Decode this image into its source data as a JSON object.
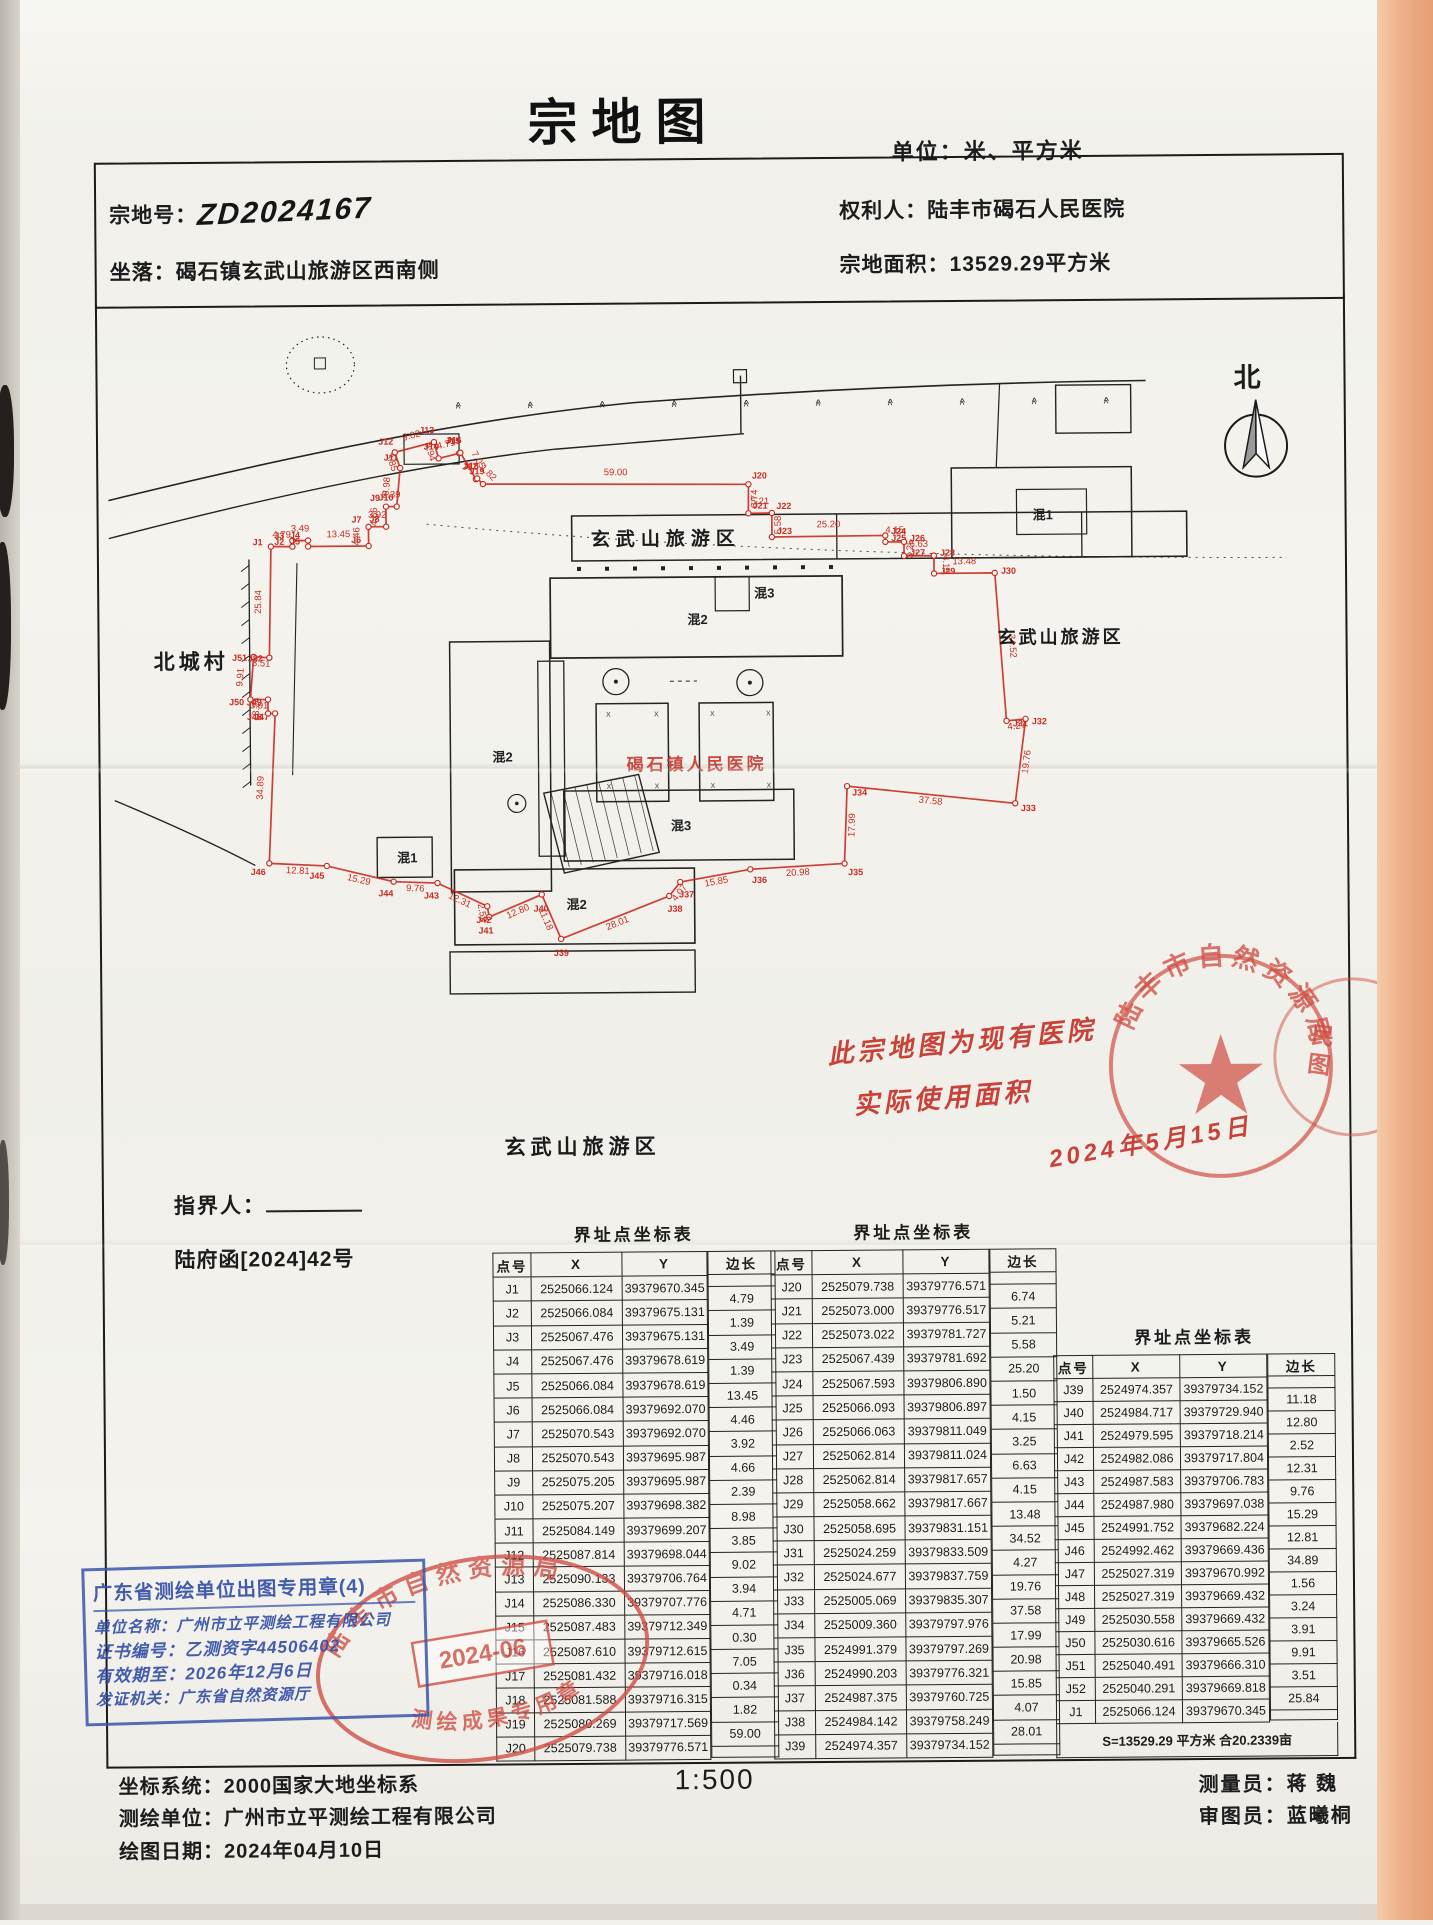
{
  "title": "宗地图",
  "unit_note": "单位：米、平方米",
  "header": {
    "parcel_no_label": "宗地号：",
    "parcel_no": "ZD2024167",
    "location_label": "坐落：",
    "location": "碣石镇玄武山旅游区西南侧",
    "owner_label": "权利人：",
    "owner": "陆丰市碣石人民医院",
    "area_label": "宗地面积：",
    "area": "13529.29平方米"
  },
  "compass": {
    "label": "北"
  },
  "map": {
    "labels": [
      {
        "role": "tourist-area-top",
        "text": "玄武山旅游区"
      },
      {
        "role": "village-left",
        "text": "北城村"
      },
      {
        "role": "tourist-area-right",
        "text": "玄武山旅游区"
      },
      {
        "role": "tourist-area-bottom",
        "text": "玄武山旅游区"
      },
      {
        "role": "hospital-name",
        "text": "碣石镇人民医院",
        "color": "#c5342b"
      }
    ],
    "building_labels": [
      "混2",
      "混3",
      "混2",
      "混3",
      "混2",
      "混1",
      "混1"
    ],
    "boundary_color": "#c92b20"
  },
  "annotations": {
    "pointer_label": "指界人：",
    "doc_ref": "陆府函[2024]42号",
    "note_lines": [
      "此宗地图为现有医院",
      "实际使用面积",
      "2024年5月15日"
    ],
    "scale": "1:500",
    "surveyor_label": "测量员：",
    "surveyor": "蒋 魏",
    "reviewer_label": "审图员：",
    "reviewer": "蓝曦桐"
  },
  "tables": [
    {
      "title": "界址点坐标表",
      "cols": [
        "点号",
        "X",
        "Y",
        "边长"
      ],
      "rows": [
        {
          "id": "J1",
          "x": "2525066.124",
          "y": "39379670.345"
        },
        {
          "id": "J2",
          "x": "2525066.084",
          "y": "39379675.131"
        },
        {
          "id": "J3",
          "x": "2525067.476",
          "y": "39379675.131"
        },
        {
          "id": "J4",
          "x": "2525067.476",
          "y": "39379678.619"
        },
        {
          "id": "J5",
          "x": "2525066.084",
          "y": "39379678.619"
        },
        {
          "id": "J6",
          "x": "2525066.084",
          "y": "39379692.070"
        },
        {
          "id": "J7",
          "x": "2525070.543",
          "y": "39379692.070"
        },
        {
          "id": "J8",
          "x": "2525070.543",
          "y": "39379695.987"
        },
        {
          "id": "J9",
          "x": "2525075.205",
          "y": "39379695.987"
        },
        {
          "id": "J10",
          "x": "2525075.207",
          "y": "39379698.382"
        },
        {
          "id": "J11",
          "x": "2525084.149",
          "y": "39379699.207"
        },
        {
          "id": "J12",
          "x": "2525087.814",
          "y": "39379698.044"
        },
        {
          "id": "J13",
          "x": "2525090.133",
          "y": "39379706.764"
        },
        {
          "id": "J14",
          "x": "2525086.330",
          "y": "39379707.776"
        },
        {
          "id": "J15",
          "x": "2525087.483",
          "y": "39379712.349"
        },
        {
          "id": "J16",
          "x": "2525087.610",
          "y": "39379712.615"
        },
        {
          "id": "J17",
          "x": "2525081.432",
          "y": "39379716.018"
        },
        {
          "id": "J18",
          "x": "2525081.588",
          "y": "39379716.315"
        },
        {
          "id": "J19",
          "x": "2525080.269",
          "y": "39379717.569"
        },
        {
          "id": "J20",
          "x": "2525079.738",
          "y": "39379776.571"
        }
      ],
      "lens": [
        "4.79",
        "1.39",
        "3.49",
        "1.39",
        "13.45",
        "4.46",
        "3.92",
        "4.66",
        "2.39",
        "8.98",
        "3.85",
        "9.02",
        "3.94",
        "4.71",
        "0.30",
        "7.05",
        "0.34",
        "1.82",
        "59.00"
      ]
    },
    {
      "title": "界址点坐标表",
      "cols": [
        "点号",
        "X",
        "Y",
        "边长"
      ],
      "rows": [
        {
          "id": "J20",
          "x": "2525079.738",
          "y": "39379776.571"
        },
        {
          "id": "J21",
          "x": "2525073.000",
          "y": "39379776.517"
        },
        {
          "id": "J22",
          "x": "2525073.022",
          "y": "39379781.727"
        },
        {
          "id": "J23",
          "x": "2525067.439",
          "y": "39379781.692"
        },
        {
          "id": "J24",
          "x": "2525067.593",
          "y": "39379806.890"
        },
        {
          "id": "J25",
          "x": "2525066.093",
          "y": "39379806.897"
        },
        {
          "id": "J26",
          "x": "2525066.063",
          "y": "39379811.049"
        },
        {
          "id": "J27",
          "x": "2525062.814",
          "y": "39379811.024"
        },
        {
          "id": "J28",
          "x": "2525062.814",
          "y": "39379817.657"
        },
        {
          "id": "J29",
          "x": "2525058.662",
          "y": "39379817.667"
        },
        {
          "id": "J30",
          "x": "2525058.695",
          "y": "39379831.151"
        },
        {
          "id": "J31",
          "x": "2525024.259",
          "y": "39379833.509"
        },
        {
          "id": "J32",
          "x": "2525024.677",
          "y": "39379837.759"
        },
        {
          "id": "J33",
          "x": "2525005.069",
          "y": "39379835.307"
        },
        {
          "id": "J34",
          "x": "2525009.360",
          "y": "39379797.976"
        },
        {
          "id": "J35",
          "x": "2524991.379",
          "y": "39379797.269"
        },
        {
          "id": "J36",
          "x": "2524990.203",
          "y": "39379776.321"
        },
        {
          "id": "J37",
          "x": "2524987.375",
          "y": "39379760.725"
        },
        {
          "id": "J38",
          "x": "2524984.142",
          "y": "39379758.249"
        },
        {
          "id": "J39",
          "x": "2524974.357",
          "y": "39379734.152"
        }
      ],
      "lens": [
        "6.74",
        "5.21",
        "5.58",
        "25.20",
        "1.50",
        "4.15",
        "3.25",
        "6.63",
        "4.15",
        "13.48",
        "34.52",
        "4.27",
        "19.76",
        "37.58",
        "17.99",
        "20.98",
        "15.85",
        "4.07",
        "28.01"
      ]
    },
    {
      "title": "界址点坐标表",
      "cols": [
        "点号",
        "X",
        "Y",
        "边长"
      ],
      "rows": [
        {
          "id": "J39",
          "x": "2524974.357",
          "y": "39379734.152"
        },
        {
          "id": "J40",
          "x": "2524984.717",
          "y": "39379729.940"
        },
        {
          "id": "J41",
          "x": "2524979.595",
          "y": "39379718.214"
        },
        {
          "id": "J42",
          "x": "2524982.086",
          "y": "39379717.804"
        },
        {
          "id": "J43",
          "x": "2524987.583",
          "y": "39379706.783"
        },
        {
          "id": "J44",
          "x": "2524987.980",
          "y": "39379697.038"
        },
        {
          "id": "J45",
          "x": "2524991.752",
          "y": "39379682.224"
        },
        {
          "id": "J46",
          "x": "2524992.462",
          "y": "39379669.436"
        },
        {
          "id": "J47",
          "x": "2525027.319",
          "y": "39379670.992"
        },
        {
          "id": "J48",
          "x": "2525027.319",
          "y": "39379669.432"
        },
        {
          "id": "J49",
          "x": "2525030.558",
          "y": "39379669.432"
        },
        {
          "id": "J50",
          "x": "2525030.616",
          "y": "39379665.526"
        },
        {
          "id": "J51",
          "x": "2525040.491",
          "y": "39379666.310"
        },
        {
          "id": "J52",
          "x": "2525040.291",
          "y": "39379669.818"
        },
        {
          "id": "J1",
          "x": "2525066.124",
          "y": "39379670.345"
        }
      ],
      "lens": [
        "11.18",
        "12.80",
        "2.52",
        "12.31",
        "9.76",
        "15.29",
        "12.81",
        "34.89",
        "1.56",
        "3.24",
        "3.91",
        "9.91",
        "3.51",
        "25.84"
      ],
      "summary": "S=13529.29 平方米 合20.2339亩"
    }
  ],
  "stamps": {
    "blue": {
      "title": "广东省测绘单位出图专用章(4)",
      "lines": [
        "单位名称：广州市立平测绘工程有限公司",
        "证书编号：乙测资字44506402",
        "有效期至：2026年12月6日",
        "发证机关：广东省自然资源厅"
      ],
      "color": "#3b55a8"
    },
    "red_round": {
      "text": "陆丰市自然资源局",
      "color": "#d04f45"
    },
    "red_oval": {
      "arc_top": "陆丰市自然资源局",
      "date": "2024-06",
      "arc_bottom": "测绘成果专用章",
      "color": "#d04f45"
    },
    "edge_fragment": "民图"
  },
  "footer": {
    "lines": [
      "坐标系统：2000国家大地坐标系",
      "测绘单位：广州市立平测绘工程有限公司",
      "绘图日期：2024年04月10日"
    ]
  }
}
